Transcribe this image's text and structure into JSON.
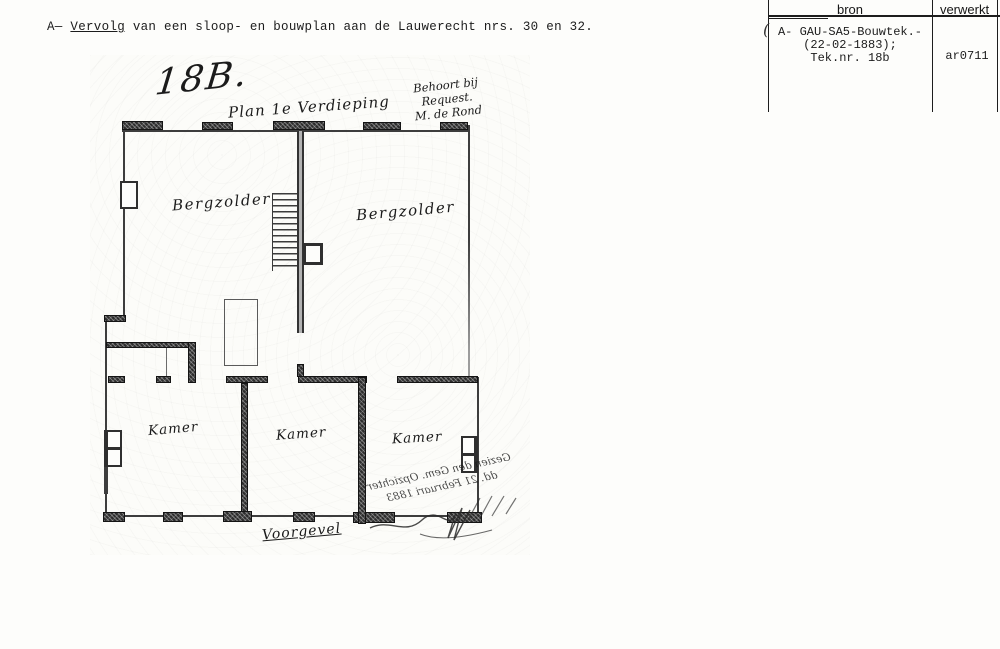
{
  "caption": {
    "prefix": "A— ",
    "underlined": "Vervolg",
    "rest": " van een sloop- en bouwplan aan de Lauwerecht nrs. 30 en 32."
  },
  "catalog": {
    "col_bron": "bron",
    "col_verwerkt": "verwerkt",
    "bron_lines": [
      "A- GAU-SA5-Bouwtek.-",
      "(22-02-1883);",
      "Tek.nr. 18b"
    ],
    "verwerkt_value": "ar0711",
    "pen_mark": "("
  },
  "plan": {
    "sheet_number": "18B.",
    "title": "Plan 1e Verdieping",
    "note_line1": "Behoort bij Request.",
    "note_line2": "M. de Rond",
    "room_left_upper": "Bergzolder",
    "room_right_upper": "Bergzolder",
    "kamers": [
      "Kamer",
      "Kamer",
      "Kamer"
    ],
    "facade": "Voorgevel",
    "bleedthrough_line1": "Gezien den Gem. Opzichter",
    "bleedthrough_line2": "dd. 21 Februari 1883"
  },
  "colors": {
    "ink": "#1c1c1c",
    "paper": "#fdfdfb",
    "wall_dark": "#2d2d2d",
    "wall_gray": "#b2b2b2"
  }
}
